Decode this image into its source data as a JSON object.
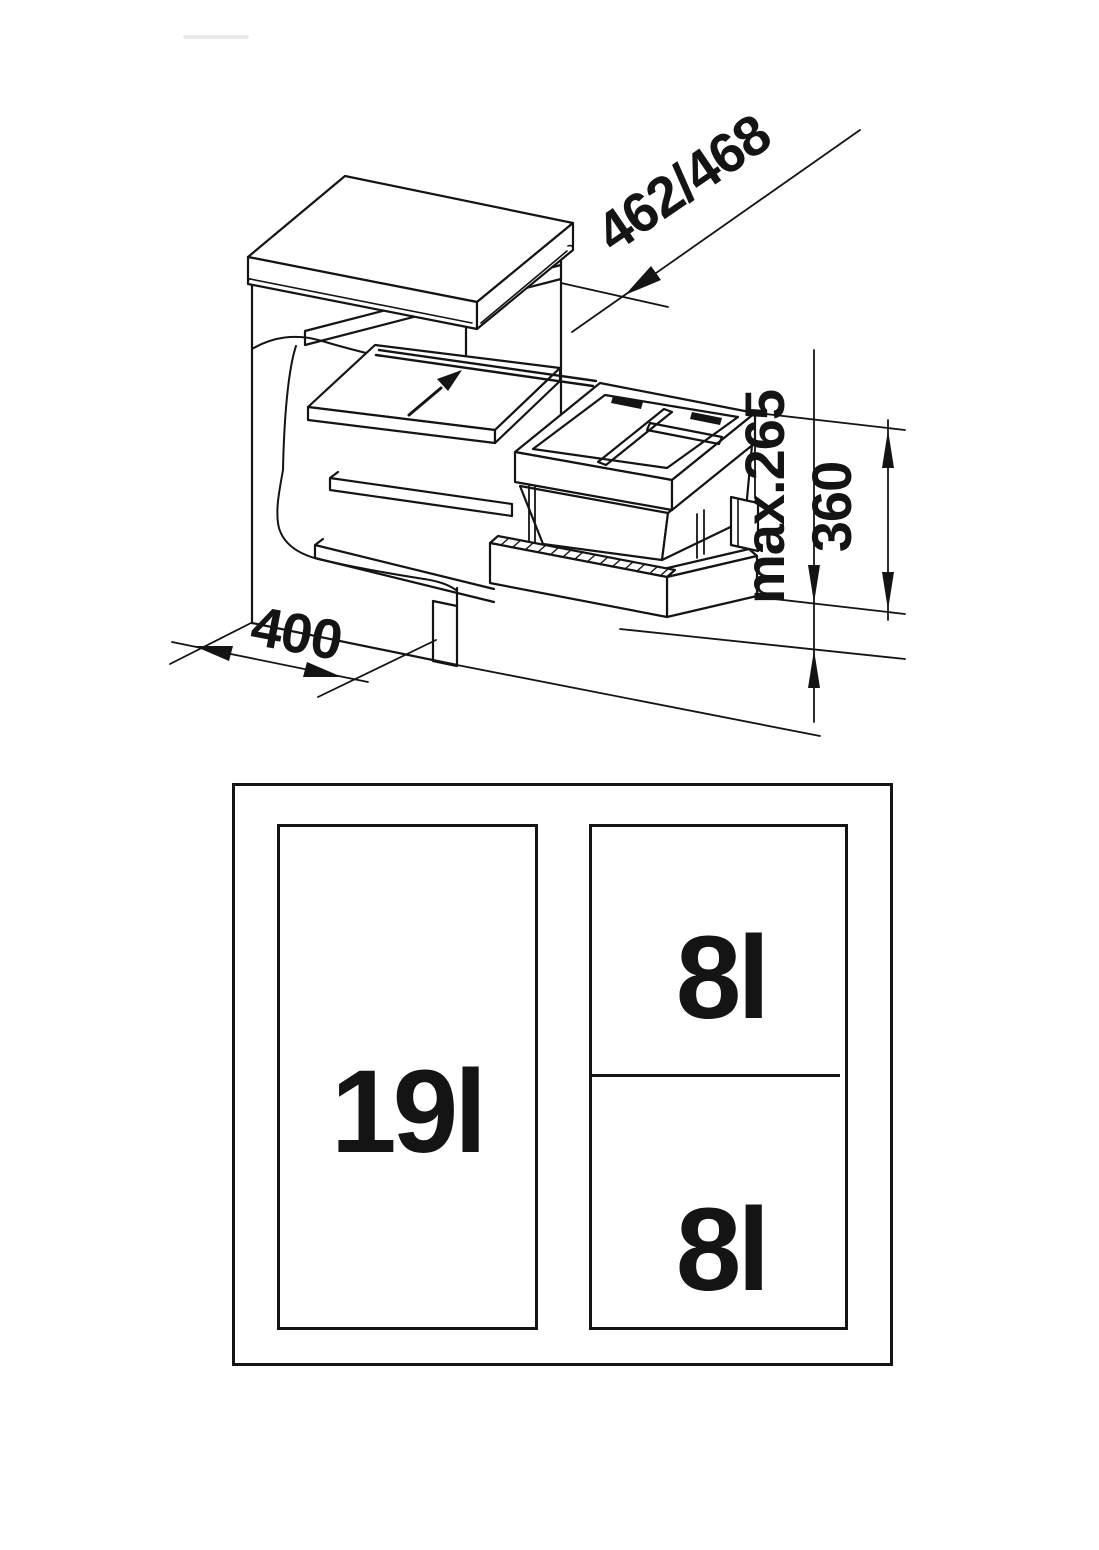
{
  "drawing": {
    "dim_depth": "462/468",
    "dim_max_height": "max.265",
    "dim_unit_height": "360",
    "dim_width": "400"
  },
  "top_view": {
    "large_bin": "19l",
    "small_bin_top": "8l",
    "small_bin_bottom": "8l"
  },
  "colors": {
    "line": "#141414",
    "background": "#ffffff"
  }
}
